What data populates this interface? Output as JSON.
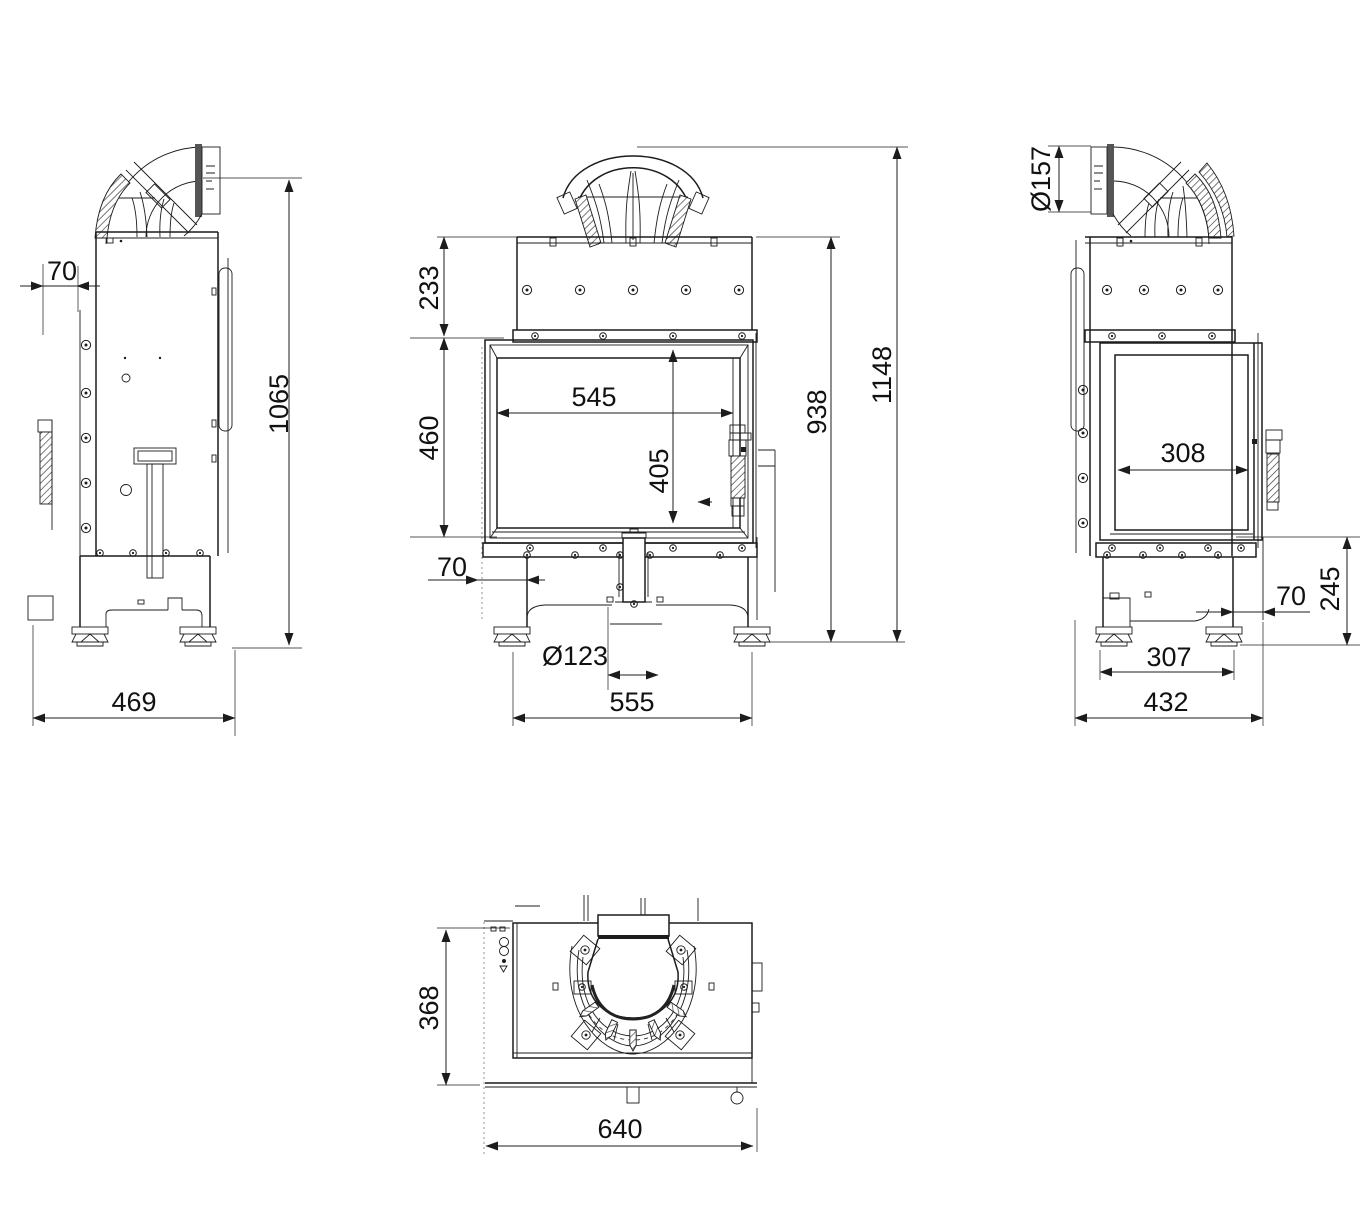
{
  "drawing": {
    "background": "#ffffff",
    "line_color": "#1c1c1c",
    "dims": {
      "left": {
        "front_offset": "70",
        "total_height": "1065",
        "depth": "469"
      },
      "front": {
        "upper_section": "233",
        "door_height": "460",
        "glass_width": "545",
        "glass_height": "405",
        "base_offset": "70",
        "flue_diameter": "Ø123",
        "base_width": "555",
        "body_height": "938",
        "total_height": "1148"
      },
      "right": {
        "flue_diameter": "Ø157",
        "glass_width": "308",
        "rear_offset": "70",
        "plinth_height": "245",
        "feet_spacing": "307",
        "total_depth": "432"
      },
      "top": {
        "body_depth": "368",
        "total_width": "640"
      }
    }
  }
}
